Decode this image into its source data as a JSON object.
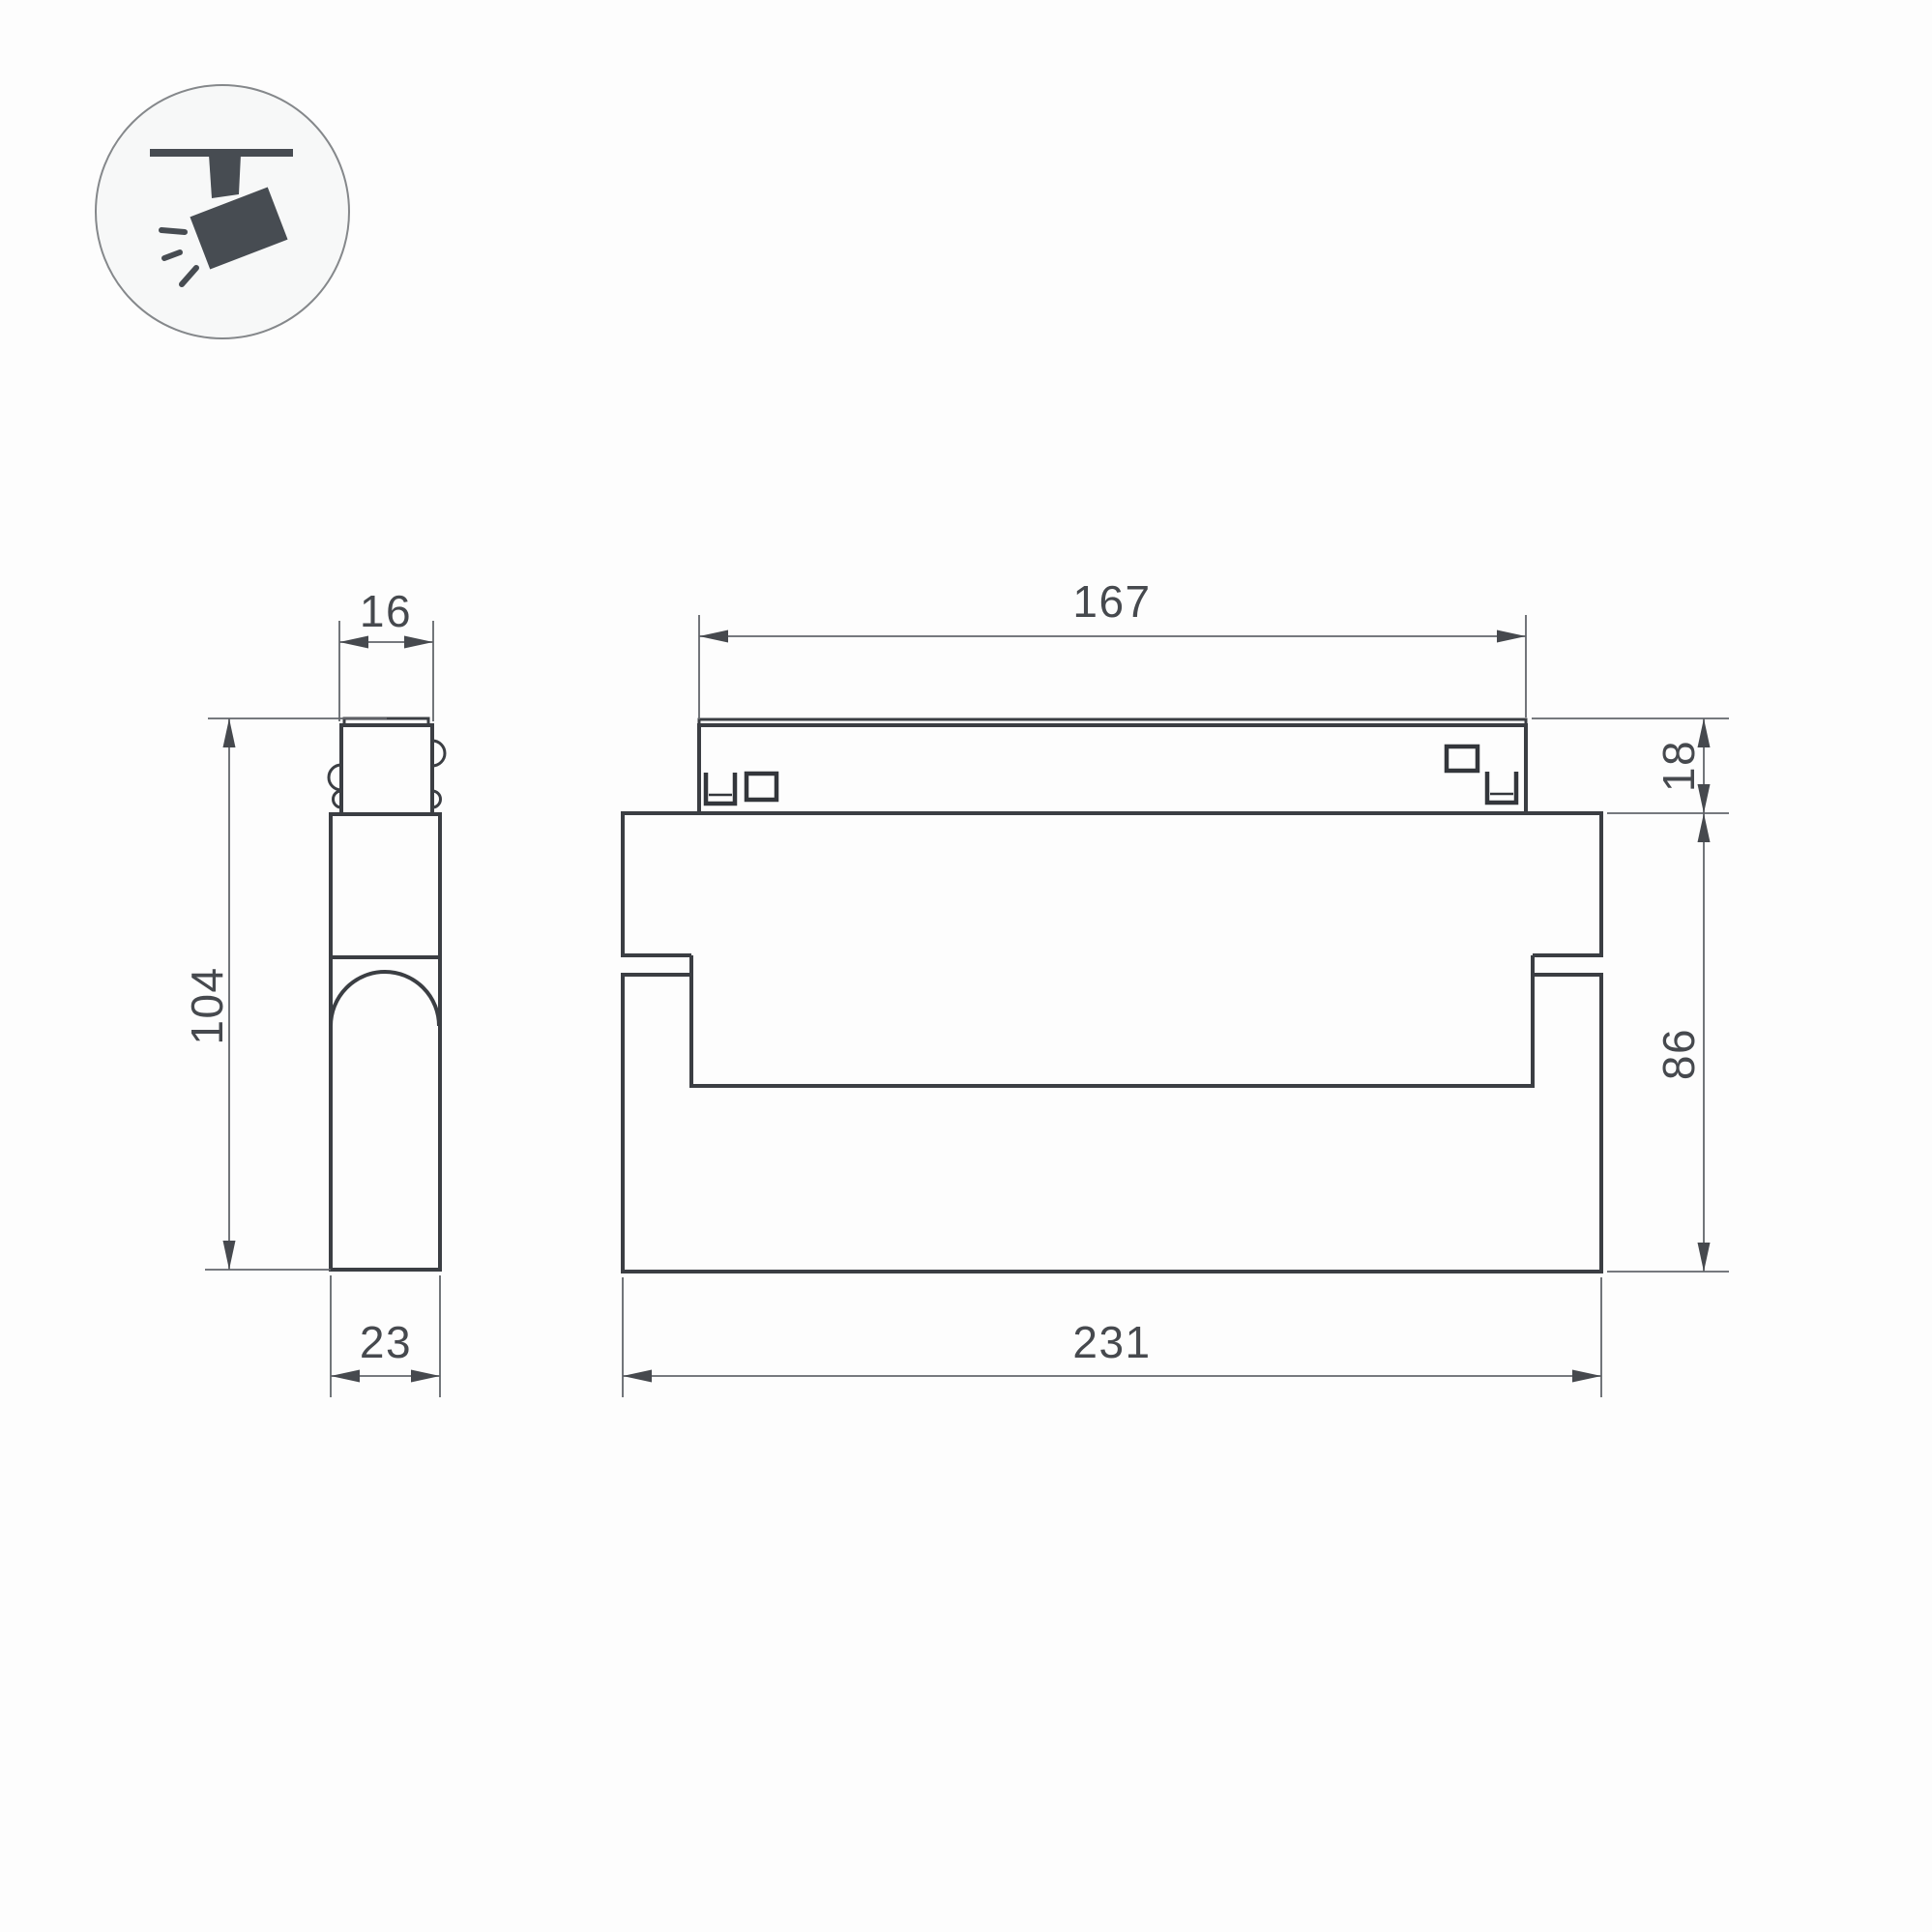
{
  "drawing": {
    "type": "technical-dimension-drawing",
    "subject": "track-mounted linear spotlight, two orthographic views",
    "icon": {
      "name": "track-spotlight-icon"
    },
    "colors": {
      "background": "#fdfdfd",
      "object_line": "#3b3e43",
      "dimension_line": "#63666b",
      "text": "#46494e",
      "icon_glyph": "#474c52",
      "icon_circle_fill": "#f7f8f8",
      "icon_circle_stroke": "#85888b"
    },
    "dimensions": {
      "side_top_width": "16",
      "side_height": "104",
      "side_depth": "23",
      "front_track_length": "167",
      "front_adapter_height": "18",
      "front_body_height": "86",
      "front_body_width": "231"
    }
  }
}
